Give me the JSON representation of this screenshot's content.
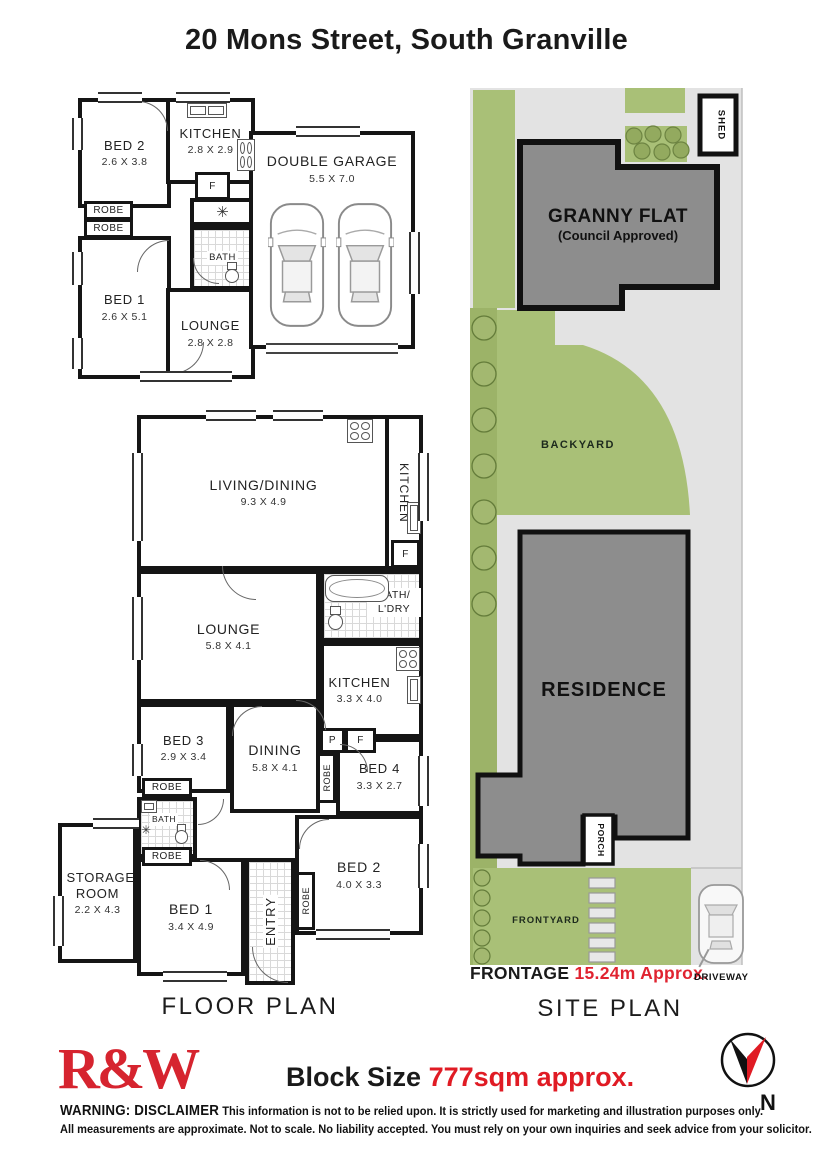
{
  "title": "20 Mons Street, South Granville",
  "gp": {
    "bed2": "BED 2",
    "bed2_d": "2.6 X 3.8",
    "kitchen": "KITCHEN",
    "kitchen_d": "2.8 X 2.9",
    "f": "F",
    "robe1": "ROBE",
    "robe2": "ROBE",
    "bath": "BATH",
    "bed1": "BED 1",
    "bed1_d": "2.6 X 5.1",
    "lounge": "LOUNGE",
    "lounge_d": "2.8 X 2.8",
    "garage": "DOUBLE GARAGE",
    "garage_d": "5.5 X 7.0",
    "fan_icon": "✳"
  },
  "fp": {
    "label": "FLOOR PLAN",
    "living": "LIVING/DINING",
    "living_d": "9.3 X 4.9",
    "kitchen1": "KITCHEN",
    "f1": "F",
    "lounge": "LOUNGE",
    "lounge_d": "5.8 X 4.1",
    "bath_ldry1": "BATH/",
    "bath_ldry2": "L'DRY",
    "kitchen2": "KITCHEN",
    "kitchen2_d": "3.3 X 4.0",
    "bed3": "BED 3",
    "bed3_d": "2.9 X 3.4",
    "dining": "DINING",
    "dining_d": "5.8 X 4.1",
    "p": "P",
    "f2": "F",
    "robe_v1": "ROBE",
    "bed4": "BED 4",
    "bed4_d": "3.3 X 2.7",
    "robe_h1": "ROBE",
    "bath_small": "BATH",
    "robe_h2": "ROBE",
    "bed2": "BED 2",
    "bed2_d": "4.0 X 3.3",
    "robe_v2": "ROBE",
    "storage": "STORAGE ROOM",
    "storage_d": "2.2 X 4.3",
    "bed1": "BED 1",
    "bed1_d": "3.4 X 4.9",
    "entry": "ENTRY",
    "fan_icon": "✳"
  },
  "sp": {
    "label": "SITE PLAN",
    "shed": "SHED",
    "granny1": "GRANNY FLAT",
    "granny2": "(Council Approved)",
    "backyard": "BACKYARD",
    "residence": "RESIDENCE",
    "porch": "PORCH",
    "frontyard": "FRONTYARD",
    "frontage_label": "FRONTAGE",
    "frontage_value": "15.24m Approx.",
    "driveway": "DRIVEWAY"
  },
  "footer": {
    "logo": "R&W",
    "block_label": "Block Size",
    "block_value": "777sqm approx.",
    "warn": "WARNING: DISCLAIMER",
    "disc1": "This information is not to be relied upon. It is strictly used for marketing and illustration purposes only.",
    "disc2": "All measurements are approximate. Not to scale. No liability accepted. You must rely on your own inquiries and seek advice from your solicitor.",
    "north": "N"
  },
  "colors": {
    "brand_red": "#d6242f",
    "highlight_red": "#e02330",
    "grass_green": "#a9c077",
    "tree_band_green": "#9cb368",
    "building_grey": "#8d8d8d",
    "paving_grey": "#e3e3e3",
    "wall_black": "#151515"
  }
}
